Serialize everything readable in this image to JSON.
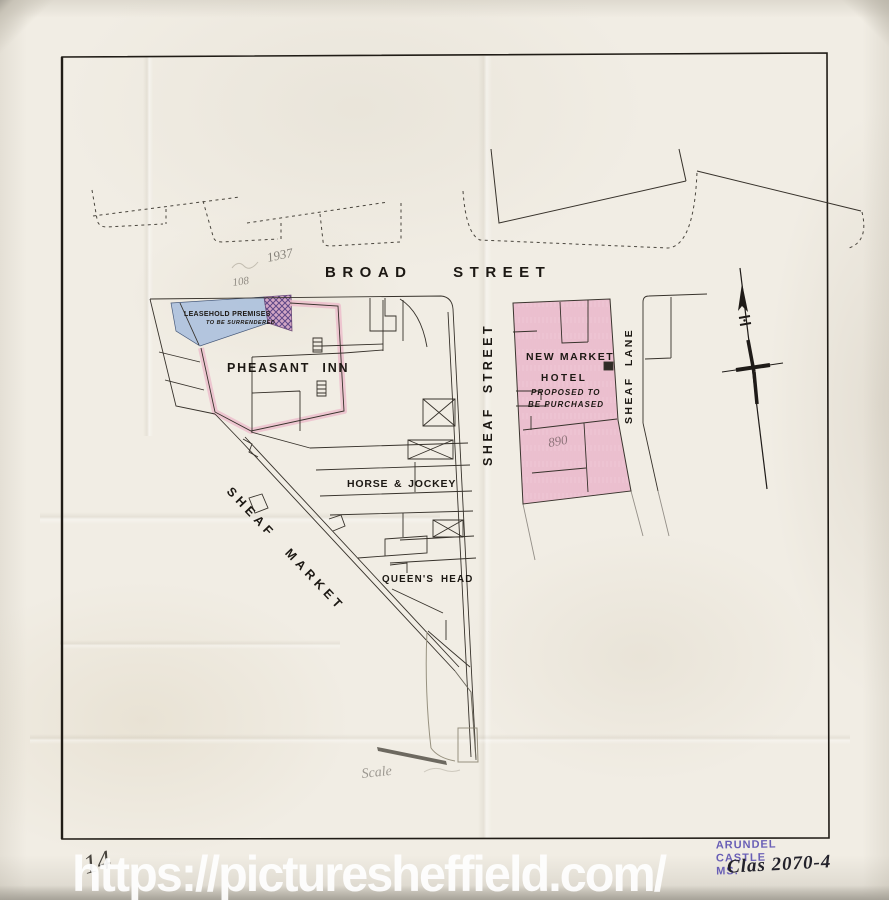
{
  "sheet": {
    "watermark": "https://picturesheffield.com/",
    "pencil_sheet_number": "14"
  },
  "map": {
    "streets": {
      "broad_street": "BROAD STREET",
      "sheaf_street": "SHEAF STREET",
      "sheaf_lane": "SHEAF LANE",
      "sheaf_market": "SHEAF MARKET"
    },
    "premises": {
      "pheasant_inn": "PHEASANT INN",
      "horse_and_jockey": "HORSE & JOCKEY",
      "queens_head": "QUEEN'S HEAD",
      "new_market_hotel": {
        "name_line1": "NEW MARKET",
        "name_line2": "HOTEL",
        "status_line1": "PROPOSED TO",
        "status_line2": "BE PURCHASED"
      },
      "leasehold": {
        "line1": "LEASEHOLD PREMISES",
        "line2": "TO BE SURRENDERED"
      }
    },
    "legend_colors": {
      "proposed_purchase_pink": "#edc3d2",
      "leasehold_blue": "#a8bedd",
      "ink": "#37322b"
    },
    "icons": {
      "compass": "north-arrow"
    }
  },
  "annotations": {
    "pencil_date_note": "1937",
    "pencil_number_note": "108",
    "pencil_area_note": "890",
    "pencil_scale_note": "Scale"
  },
  "stamp": {
    "line1": "ARUNDEL",
    "line2": "CASTLE",
    "line3": "MS.",
    "handwritten_ref": "Clas 2070-4"
  }
}
